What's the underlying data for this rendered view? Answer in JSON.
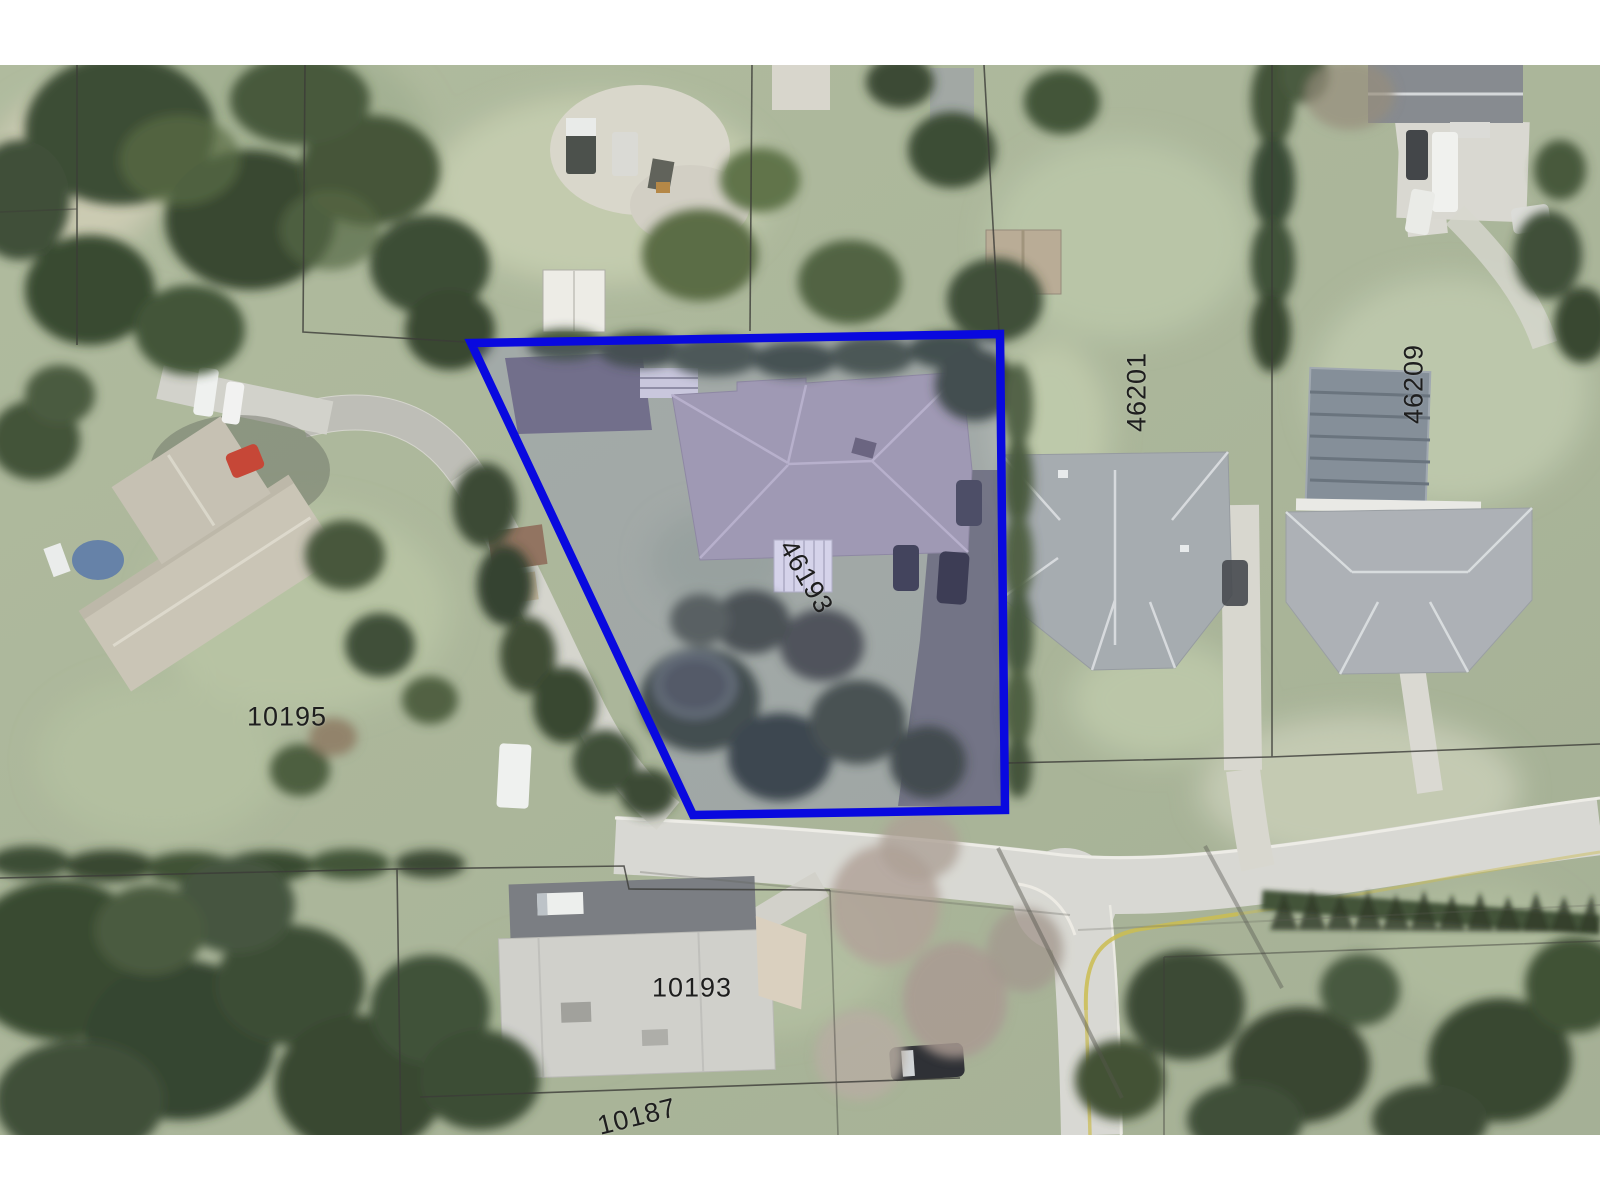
{
  "map": {
    "type": "aerial-parcel-map",
    "labels": {
      "lot_10195": "10195",
      "lot_46193": "46193",
      "lot_46201": "46201",
      "lot_46209": "46209",
      "lot_10193": "10193",
      "lot_10187": "10187"
    },
    "subject_parcel": {
      "number": "46193",
      "outline_color": "#0909df",
      "highlight_fill": "rgba(118,108,224,0.18)"
    }
  }
}
